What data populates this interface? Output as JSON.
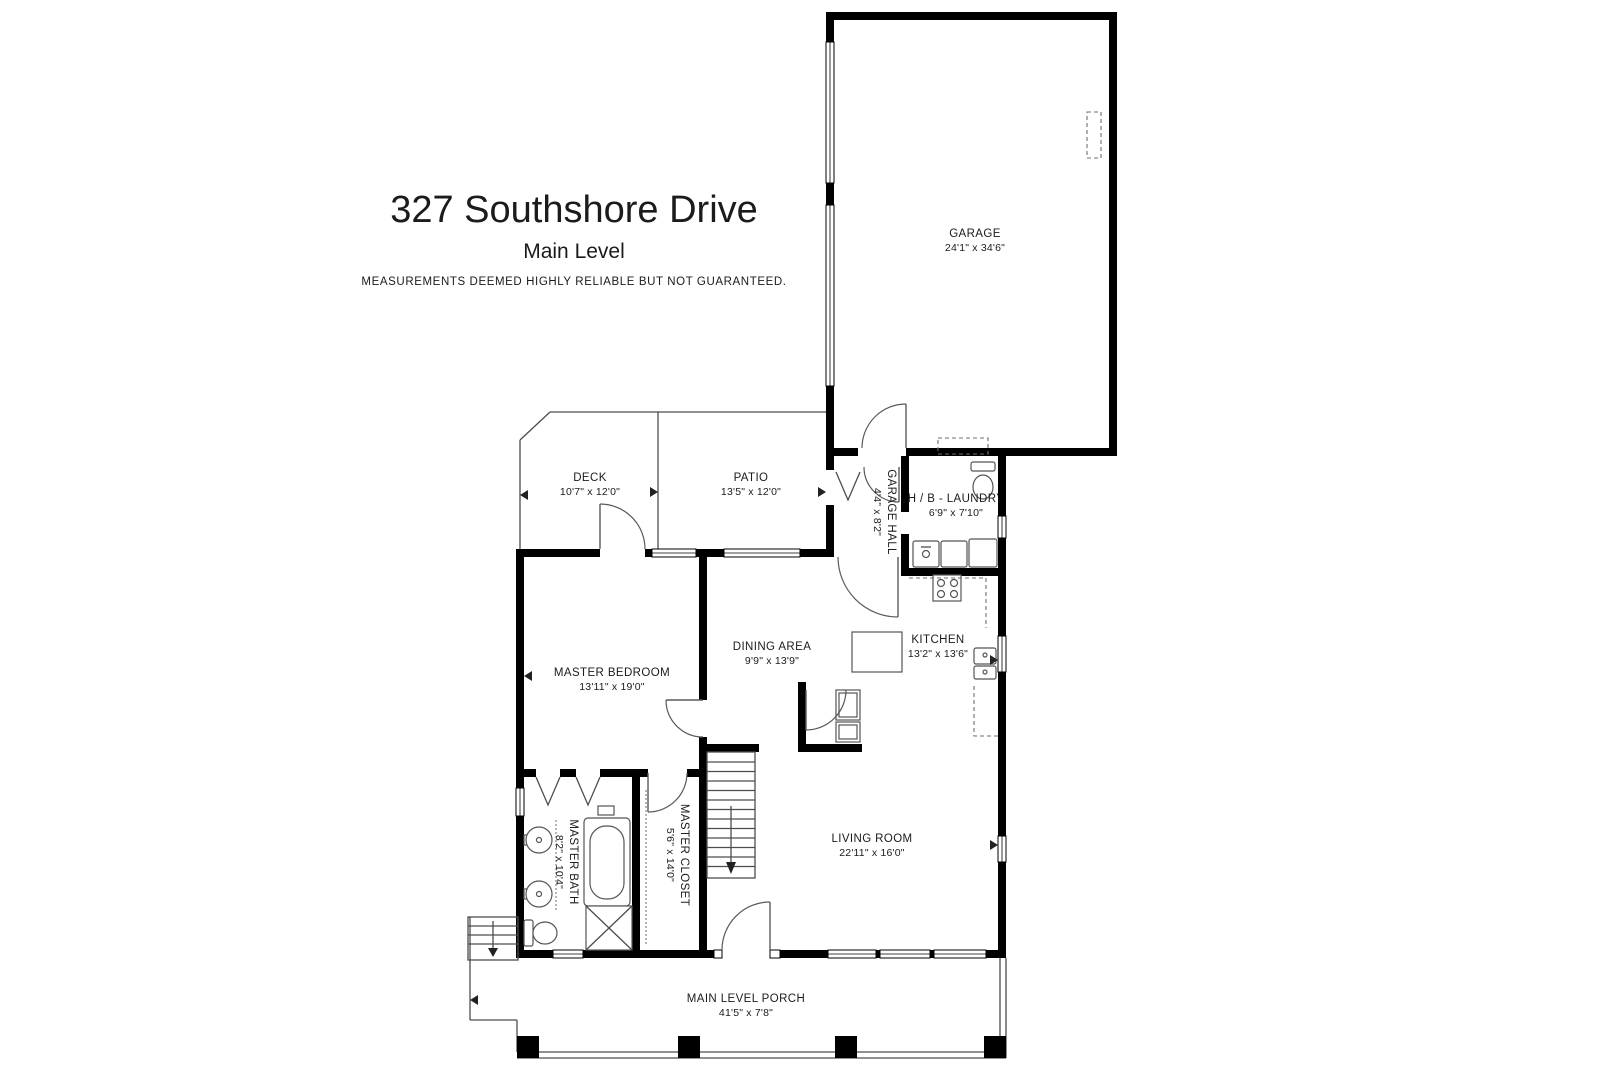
{
  "header": {
    "title": "327 Southshore Drive",
    "subtitle": "Main Level",
    "disclaimer": "MEASUREMENTS DEEMED HIGHLY RELIABLE BUT NOT GUARANTEED."
  },
  "rooms": {
    "garage": {
      "label": "GARAGE",
      "dims": "24'1\" x 34'6\""
    },
    "deck": {
      "label": "DECK",
      "dims": "10'7\" x 12'0\""
    },
    "patio": {
      "label": "PATIO",
      "dims": "13'5\" x 12'0\""
    },
    "garage_hall": {
      "label": "GARAGE HALL",
      "dims": "4'4\" x 8'2\""
    },
    "hb_laundry": {
      "label": "H / B - LAUNDRY",
      "dims": "6'9\" x 7'10\""
    },
    "dining_area": {
      "label": "DINING AREA",
      "dims": "9'9\" x 13'9\""
    },
    "kitchen": {
      "label": "KITCHEN",
      "dims": "13'2\" x 13'6\""
    },
    "master_bedroom": {
      "label": "MASTER BEDROOM",
      "dims": "13'11\" x 19'0\""
    },
    "master_bath": {
      "label": "MASTER BATH",
      "dims": "8'2\" x 10'4\""
    },
    "master_closet": {
      "label": "MASTER CLOSET",
      "dims": "5'6\" x 14'0\""
    },
    "living_room": {
      "label": "LIVING ROOM",
      "dims": "22'11\" x 16'0\""
    },
    "main_level_porch": {
      "label": "MAIN LEVEL PORCH",
      "dims": "41'5\" x 7'8\""
    }
  },
  "colors": {
    "wall": "#000000",
    "thin_line": "#4d4d4d",
    "text": "#1b1b1b",
    "background": "#ffffff"
  }
}
